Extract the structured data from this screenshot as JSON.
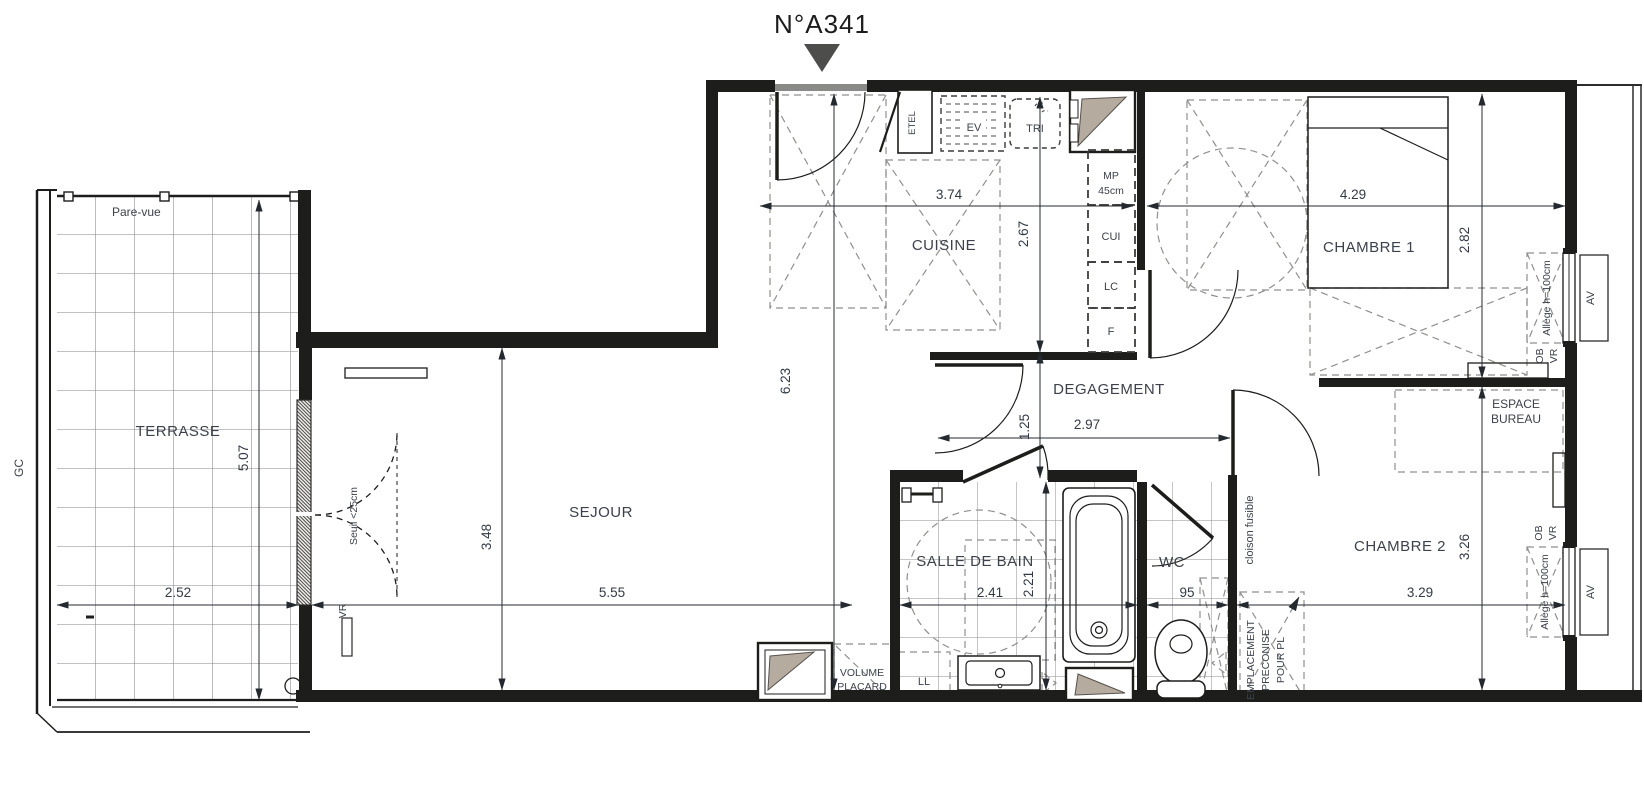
{
  "title": "N°A341",
  "colors": {
    "wall": "#1d1d1b",
    "dash_zone": "#8f8f8d",
    "shaft_beige": "#b5ab9e",
    "entry_marker": "#4d4d4b",
    "grid": "#85858a",
    "dim_text": "#333a45"
  },
  "rooms": {
    "terrasse": "TERRASSE",
    "sejour": "SEJOUR",
    "cuisine": "CUISINE",
    "chambre1": "CHAMBRE 1",
    "chambre2": "CHAMBRE 2",
    "salle_de_bain": "SALLE DE BAIN",
    "wc": "WC",
    "degagement": "DEGAGEMENT"
  },
  "annotations": {
    "pare_vue": "Pare-vue",
    "gc": "GC",
    "seuil": "Seuil <25cm",
    "vr_sejour": "VR",
    "etel": "ETEL",
    "ev": "EV",
    "tri": "TRI",
    "mp_line1": "MP",
    "mp_line2": "45cm",
    "cui": "CUI",
    "lc": "LC",
    "f": "F",
    "allege_ch1": "Allège h=100cm",
    "ob_ch1": "OB",
    "vr_ch1": "VR",
    "av_ch1": "AV",
    "allege_ch2": "Allège h=100cm",
    "ob_ch2": "OB",
    "vr_ch2": "VR",
    "av_ch2": "AV",
    "espace_bureau_line1": "ESPACE",
    "espace_bureau_line2": "BUREAU",
    "cloison_fusible": "cloison fusible",
    "volume_placard_line1": "VOLUME",
    "volume_placard_line2": "PLACARD",
    "ll": "LL",
    "empl_line1": "EMPLACEMENT",
    "empl_line2": "PRECONISE",
    "empl_line3": "POUR PL"
  },
  "dims": {
    "terrasse_w": "2.52",
    "terrasse_h": "5.07",
    "sejour_w": "5.55",
    "sejour_h": "3.48",
    "cuisine_w": "3.74",
    "cuisine_h": "2.67",
    "hall_h": "6.23",
    "ch1_w": "4.29",
    "ch1_h": "2.82",
    "deg_w": "2.97",
    "deg_h": "1.25",
    "sdb_w": "2.41",
    "sdb_h": "2.21",
    "wc_w": "95",
    "ch2_w": "3.29",
    "ch2_h": "3.26"
  }
}
